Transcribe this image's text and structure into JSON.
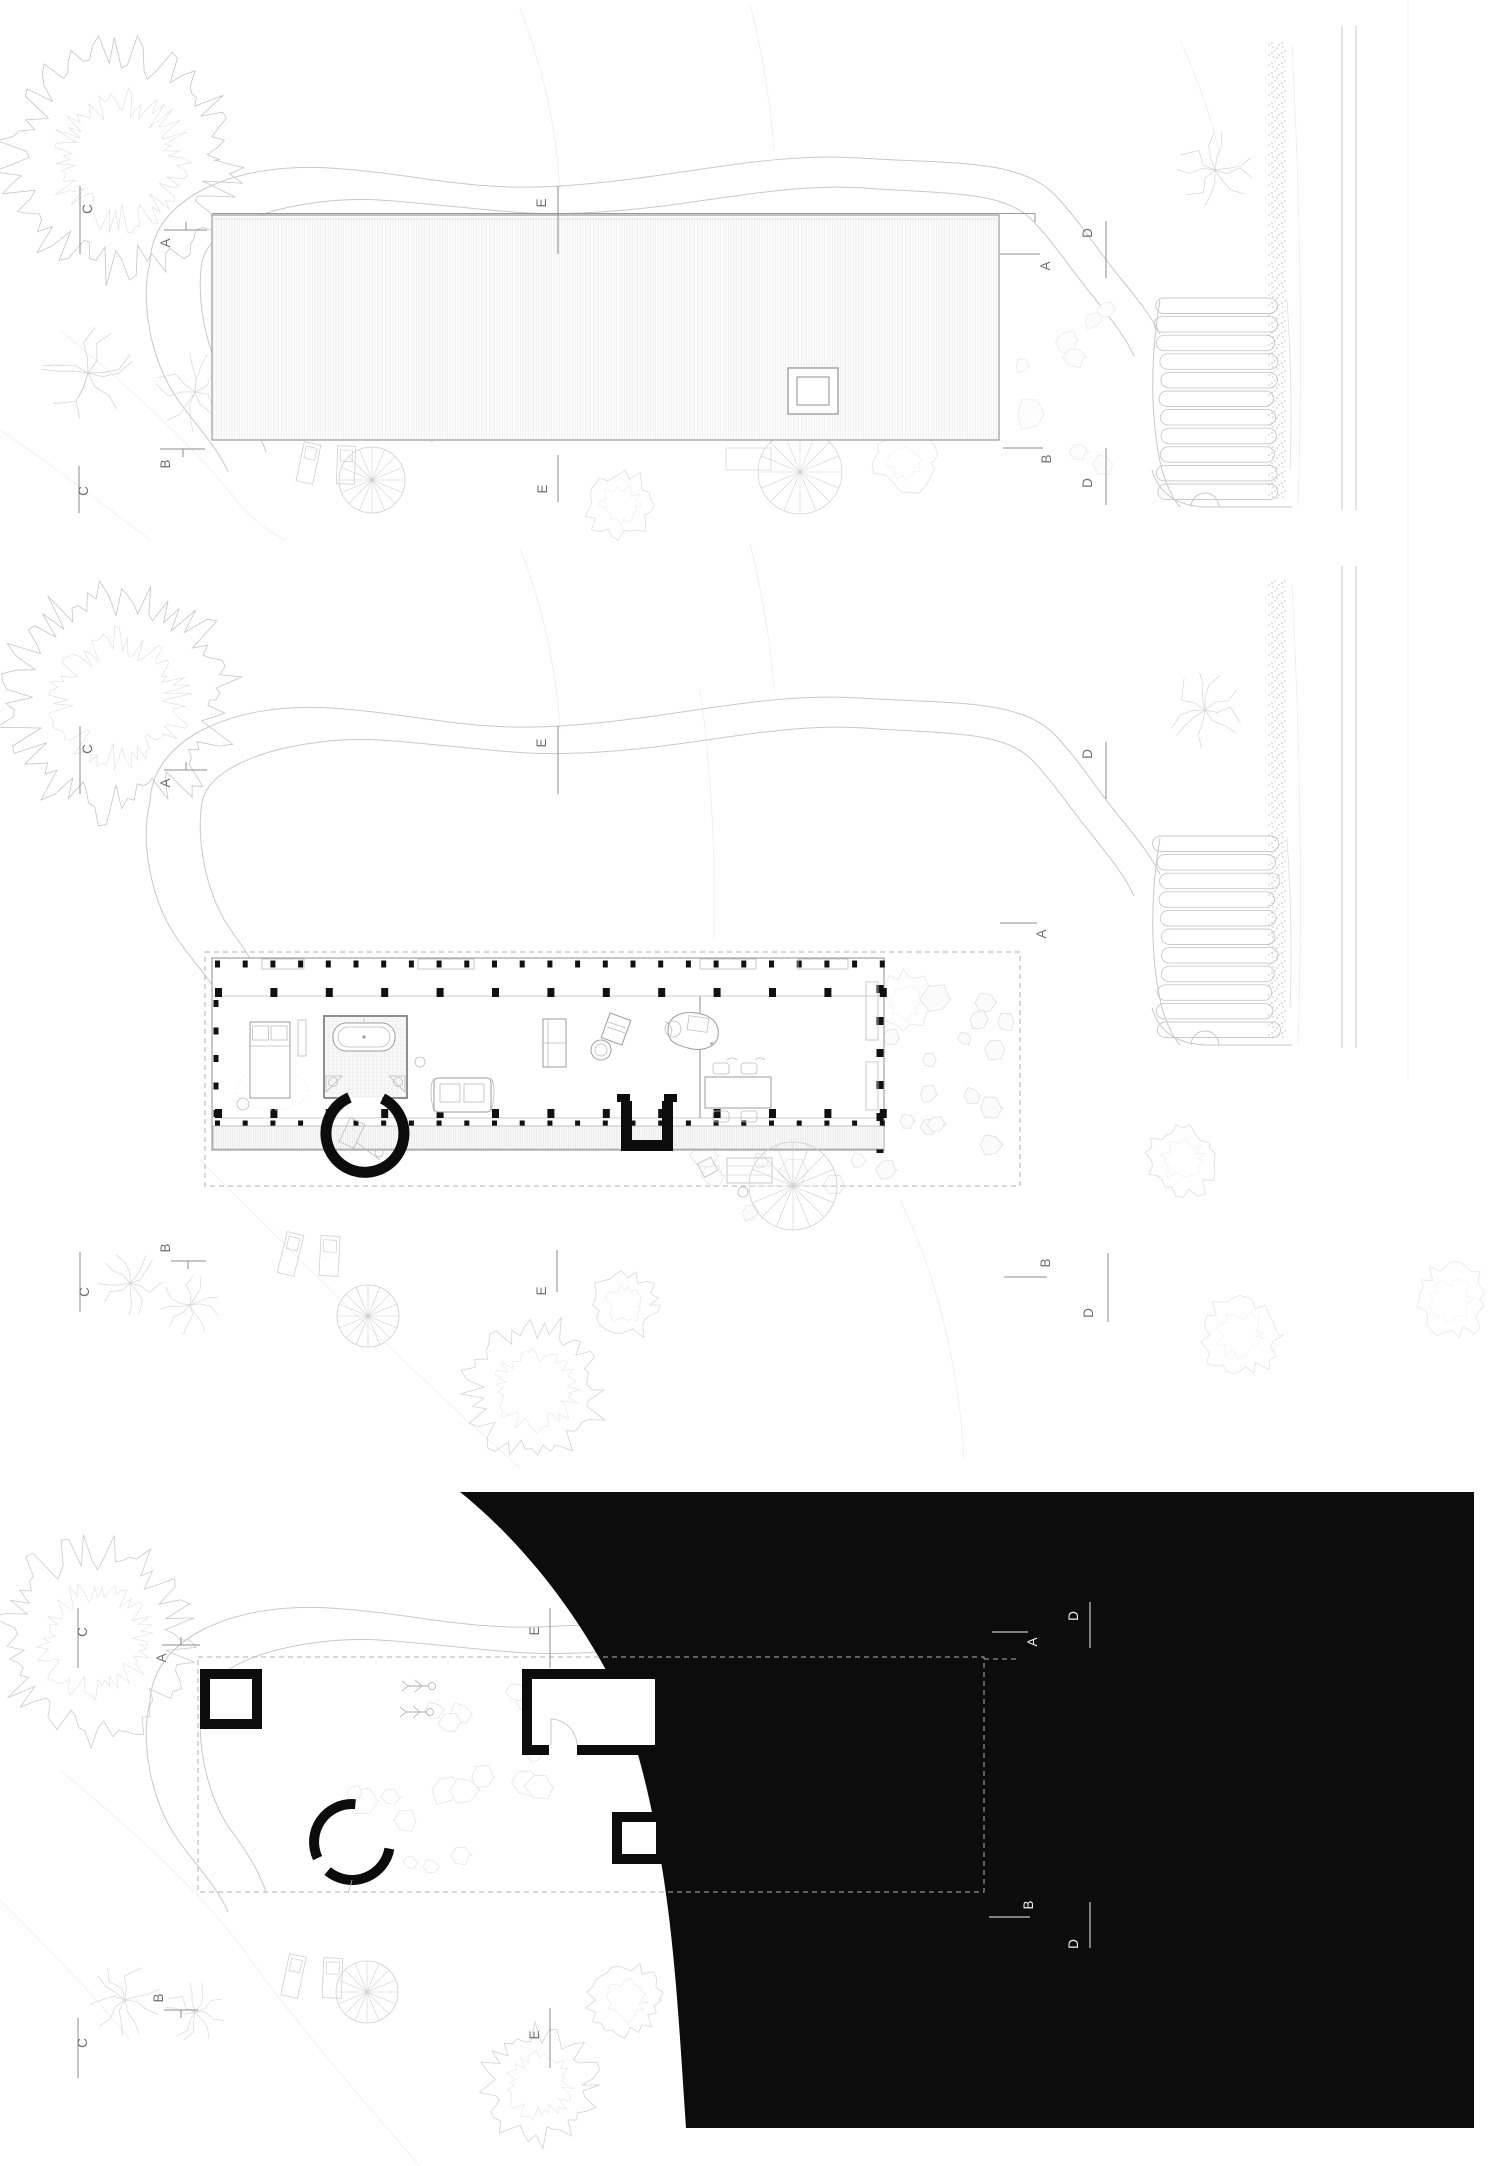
{
  "sheet": {
    "background_color": "#ffffff",
    "poche_color": "#0c0c0c",
    "line_color_light": "#c9c9c9",
    "line_color_medium": "#9a9a9a",
    "marker_color": "#6f6f6f",
    "marker_color_on_black": "#f2f2f2"
  },
  "panels": {
    "roof_plan": {
      "markers": {
        "c_top": "C",
        "a_left": "A",
        "e_top": "E",
        "b_left": "B",
        "c_bottom": "C",
        "e_bottom": "E",
        "a_right": "A",
        "d_right_top": "D",
        "b_right": "B",
        "d_right_bottom": "D"
      }
    },
    "floor_plan": {
      "markers": {
        "c_top": "C",
        "a_left": "A",
        "e_top": "E",
        "b_left": "B",
        "c_bottom": "C",
        "e_bottom": "E",
        "a_right": "A",
        "d_right_top": "D",
        "b_right": "B",
        "d_right_bottom": "D"
      }
    },
    "basement_plan": {
      "markers": {
        "c_top": "C",
        "a_left": "A",
        "e_top": "E",
        "b_left": "B",
        "c_bottom": "C",
        "e_bottom": "E",
        "a_right": "A",
        "d_right_top": "D",
        "b_right": "B",
        "d_right_bottom": "D"
      }
    }
  }
}
